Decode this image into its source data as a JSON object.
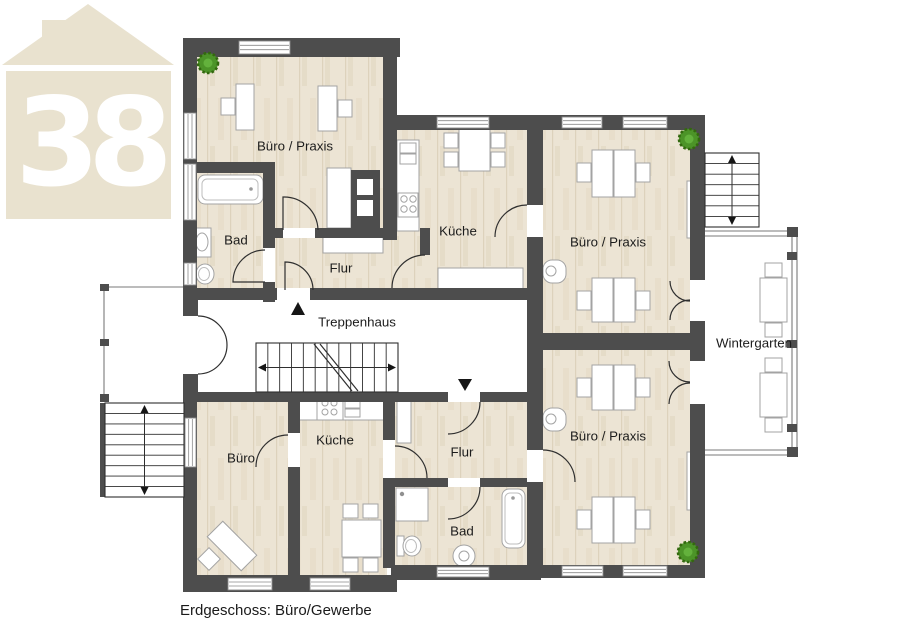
{
  "page": {
    "background": "#ffffff"
  },
  "caption": "Erdgeschoss: Büro/Gewerbe",
  "logo": {
    "number": "38",
    "color": "#e9e2cf"
  },
  "colors": {
    "wall": "#4d4d4d",
    "line": "#2f2f2f",
    "furniture_stroke": "#a3a3a3",
    "window_frame": "#8a8a8a",
    "frame": "#7a7a7a",
    "text": "#1c1c1c",
    "plant": "#4c9428",
    "plant_dark": "#33680f",
    "plant_light": "#63b13c",
    "wood_base": "#ece4d4",
    "wood_grain": "#ddd2bc"
  },
  "floorplan": {
    "wood_floors": [
      [
        197,
        52,
        190,
        184
      ],
      [
        197,
        170,
        70,
        126
      ],
      [
        268,
        230,
        162,
        62
      ],
      [
        395,
        128,
        135,
        165
      ],
      [
        540,
        128,
        152,
        205
      ],
      [
        540,
        350,
        152,
        218
      ],
      [
        197,
        398,
        95,
        180
      ],
      [
        296,
        398,
        91,
        180
      ],
      [
        391,
        398,
        138,
        84
      ],
      [
        391,
        484,
        138,
        84
      ]
    ],
    "white_floors": [
      [
        197,
        300,
        330,
        92
      ],
      [
        106,
        288,
        78,
        114
      ],
      [
        705,
        237,
        87,
        213
      ]
    ],
    "furniture": [
      {
        "n": "desk",
        "t": "r",
        "x": 236,
        "y": 84,
        "w": 18,
        "h": 46
      },
      {
        "n": "office-chair",
        "t": "r",
        "x": 221,
        "y": 98,
        "w": 14,
        "h": 17
      },
      {
        "n": "desk",
        "t": "r",
        "x": 318,
        "y": 86,
        "w": 19,
        "h": 45
      },
      {
        "n": "office-chair",
        "t": "r",
        "x": 338,
        "y": 100,
        "w": 14,
        "h": 17
      },
      {
        "n": "kitchenette-counter",
        "t": "r",
        "x": 327,
        "y": 168,
        "w": 24,
        "h": 60
      },
      {
        "n": "duct-block",
        "t": "r",
        "x": 351,
        "y": 170,
        "w": 29,
        "h": 58,
        "f": "#4d4d4d",
        "s": "none"
      },
      {
        "n": "duct-vent",
        "t": "r",
        "x": 357,
        "y": 179,
        "w": 16,
        "h": 16,
        "s": "none"
      },
      {
        "n": "duct-vent",
        "t": "r",
        "x": 357,
        "y": 200,
        "w": 16,
        "h": 16,
        "s": "none"
      },
      {
        "n": "bathtub",
        "t": "r",
        "x": 198,
        "y": 175,
        "w": 65,
        "h": 29,
        "rx": 7
      },
      {
        "n": "bathtub-inner",
        "t": "r",
        "x": 202,
        "y": 179,
        "w": 56,
        "h": 21,
        "rx": 5,
        "s": "#bdbdbd"
      },
      {
        "n": "drain",
        "t": "c",
        "x": 251,
        "y": 189,
        "r": 1.8,
        "f": "#9a9a9a",
        "s": "none"
      },
      {
        "n": "washbasin",
        "t": "r",
        "x": 194,
        "y": 228,
        "w": 17,
        "h": 29
      },
      {
        "n": "washbasin-bowl",
        "t": "e",
        "x": 202,
        "y": 242,
        "rx": 6,
        "ry": 9
      },
      {
        "n": "toilet-tank",
        "t": "r",
        "x": 189,
        "y": 264,
        "w": 7,
        "h": 21
      },
      {
        "n": "toilet-bowl",
        "t": "e",
        "x": 205,
        "y": 274,
        "rx": 9,
        "ry": 10
      },
      {
        "n": "toilet-seat",
        "t": "e",
        "x": 204,
        "y": 274,
        "rx": 5.5,
        "ry": 6.5,
        "s": "#bdbdbd"
      },
      {
        "n": "kitchen-counter",
        "t": "r",
        "x": 397,
        "y": 140,
        "w": 22,
        "h": 91
      },
      {
        "n": "sink-basin",
        "t": "r",
        "x": 400,
        "y": 143,
        "w": 16,
        "h": 10
      },
      {
        "n": "sink-basin",
        "t": "r",
        "x": 400,
        "y": 154,
        "w": 16,
        "h": 10
      },
      {
        "n": "stove",
        "t": "r",
        "x": 398,
        "y": 193,
        "w": 20,
        "h": 24
      },
      {
        "n": "burner",
        "t": "c",
        "x": 404,
        "y": 199,
        "r": 3.2
      },
      {
        "n": "burner",
        "t": "c",
        "x": 413,
        "y": 199,
        "r": 3.2
      },
      {
        "n": "burner",
        "t": "c",
        "x": 404,
        "y": 209,
        "r": 3.2
      },
      {
        "n": "burner",
        "t": "c",
        "x": 413,
        "y": 209,
        "r": 3.2
      },
      {
        "n": "dining-table",
        "t": "r",
        "x": 459,
        "y": 127,
        "w": 31,
        "h": 44
      },
      {
        "n": "chair",
        "t": "r",
        "x": 444,
        "y": 133,
        "w": 14,
        "h": 15
      },
      {
        "n": "chair",
        "t": "r",
        "x": 444,
        "y": 152,
        "w": 14,
        "h": 15
      },
      {
        "n": "chair",
        "t": "r",
        "x": 491,
        "y": 133,
        "w": 14,
        "h": 15
      },
      {
        "n": "chair",
        "t": "r",
        "x": 491,
        "y": 152,
        "w": 14,
        "h": 15
      },
      {
        "n": "sideboard",
        "t": "r",
        "x": 438,
        "y": 268,
        "w": 85,
        "h": 24
      },
      {
        "n": "sideboard",
        "t": "r",
        "x": 323,
        "y": 236,
        "w": 60,
        "h": 17
      },
      {
        "n": "desk",
        "t": "r",
        "x": 592,
        "y": 150,
        "w": 21,
        "h": 47
      },
      {
        "n": "desk",
        "t": "r",
        "x": 614,
        "y": 150,
        "w": 21,
        "h": 47
      },
      {
        "n": "office-chair",
        "t": "r",
        "x": 577,
        "y": 163,
        "w": 14,
        "h": 19
      },
      {
        "n": "office-chair",
        "t": "r",
        "x": 636,
        "y": 163,
        "w": 14,
        "h": 19
      },
      {
        "n": "desk",
        "t": "r",
        "x": 592,
        "y": 278,
        "w": 21,
        "h": 44
      },
      {
        "n": "desk",
        "t": "r",
        "x": 614,
        "y": 278,
        "w": 21,
        "h": 44
      },
      {
        "n": "office-chair",
        "t": "r",
        "x": 577,
        "y": 291,
        "w": 14,
        "h": 19
      },
      {
        "n": "office-chair",
        "t": "r",
        "x": 636,
        "y": 291,
        "w": 14,
        "h": 19
      },
      {
        "n": "shelf",
        "t": "r",
        "x": 687,
        "y": 181,
        "w": 16,
        "h": 57
      },
      {
        "n": "fountain",
        "t": "r",
        "x": 543,
        "y": 260,
        "w": 23,
        "h": 23,
        "rx": 9
      },
      {
        "n": "fountain-bowl",
        "t": "c",
        "x": 551,
        "y": 271,
        "r": 5
      },
      {
        "n": "desk",
        "t": "r",
        "x": 592,
        "y": 365,
        "w": 21,
        "h": 45
      },
      {
        "n": "desk",
        "t": "r",
        "x": 614,
        "y": 365,
        "w": 21,
        "h": 45
      },
      {
        "n": "office-chair",
        "t": "r",
        "x": 577,
        "y": 378,
        "w": 14,
        "h": 19
      },
      {
        "n": "office-chair",
        "t": "r",
        "x": 636,
        "y": 378,
        "w": 14,
        "h": 19
      },
      {
        "n": "desk",
        "t": "r",
        "x": 592,
        "y": 497,
        "w": 21,
        "h": 46
      },
      {
        "n": "desk",
        "t": "r",
        "x": 614,
        "y": 497,
        "w": 21,
        "h": 46
      },
      {
        "n": "office-chair",
        "t": "r",
        "x": 577,
        "y": 510,
        "w": 14,
        "h": 19
      },
      {
        "n": "office-chair",
        "t": "r",
        "x": 636,
        "y": 510,
        "w": 14,
        "h": 19
      },
      {
        "n": "shelf",
        "t": "r",
        "x": 687,
        "y": 452,
        "w": 16,
        "h": 58
      },
      {
        "n": "fountain",
        "t": "r",
        "x": 543,
        "y": 408,
        "w": 23,
        "h": 23,
        "rx": 9
      },
      {
        "n": "fountain-bowl",
        "t": "c",
        "x": 551,
        "y": 419,
        "r": 5
      },
      {
        "n": "bistro-table",
        "t": "r",
        "x": 760,
        "y": 278,
        "w": 27,
        "h": 44
      },
      {
        "n": "chair",
        "t": "r",
        "x": 765,
        "y": 263,
        "w": 17,
        "h": 14
      },
      {
        "n": "chair",
        "t": "r",
        "x": 765,
        "y": 323,
        "w": 17,
        "h": 14
      },
      {
        "n": "bistro-table",
        "t": "r",
        "x": 760,
        "y": 373,
        "w": 27,
        "h": 44
      },
      {
        "n": "chair",
        "t": "r",
        "x": 765,
        "y": 358,
        "w": 17,
        "h": 14
      },
      {
        "n": "chair",
        "t": "r",
        "x": 765,
        "y": 418,
        "w": 17,
        "h": 14
      },
      {
        "n": "corner-desk",
        "t": "rot",
        "x": 232,
        "y": 546,
        "w": 48,
        "h": 22,
        "a": 45
      },
      {
        "n": "office-chair",
        "t": "rot",
        "x": 209,
        "y": 559,
        "w": 16,
        "h": 16,
        "a": 45
      },
      {
        "n": "kitchen-counter",
        "t": "r",
        "x": 297,
        "y": 397,
        "w": 87,
        "h": 23
      },
      {
        "n": "stove",
        "t": "r",
        "x": 317,
        "y": 397,
        "w": 26,
        "h": 23
      },
      {
        "n": "burner",
        "t": "c",
        "x": 325,
        "y": 403,
        "r": 3
      },
      {
        "n": "burner",
        "t": "c",
        "x": 334,
        "y": 403,
        "r": 3
      },
      {
        "n": "burner",
        "t": "c",
        "x": 325,
        "y": 412,
        "r": 3
      },
      {
        "n": "burner",
        "t": "c",
        "x": 334,
        "y": 412,
        "r": 3
      },
      {
        "n": "sink-basin",
        "t": "r",
        "x": 345,
        "y": 400,
        "w": 15,
        "h": 8
      },
      {
        "n": "sink-basin",
        "t": "r",
        "x": 345,
        "y": 409,
        "w": 15,
        "h": 8
      },
      {
        "n": "dining-table",
        "t": "r",
        "x": 342,
        "y": 520,
        "w": 39,
        "h": 37
      },
      {
        "n": "chair",
        "t": "r",
        "x": 343,
        "y": 504,
        "w": 15,
        "h": 14
      },
      {
        "n": "chair",
        "t": "r",
        "x": 363,
        "y": 504,
        "w": 15,
        "h": 14
      },
      {
        "n": "chair",
        "t": "r",
        "x": 343,
        "y": 558,
        "w": 15,
        "h": 14
      },
      {
        "n": "chair",
        "t": "r",
        "x": 363,
        "y": 558,
        "w": 15,
        "h": 14
      },
      {
        "n": "shelf",
        "t": "r",
        "x": 397,
        "y": 401,
        "w": 14,
        "h": 42
      },
      {
        "n": "shower",
        "t": "r",
        "x": 396,
        "y": 488,
        "w": 32,
        "h": 33
      },
      {
        "n": "shower-drain",
        "t": "c",
        "x": 402,
        "y": 494,
        "r": 2.2,
        "f": "#909090",
        "s": "none"
      },
      {
        "n": "toilet-tank",
        "t": "r",
        "x": 397,
        "y": 536,
        "w": 7,
        "h": 20
      },
      {
        "n": "toilet-bowl",
        "t": "e",
        "x": 412,
        "y": 546,
        "rx": 9,
        "ry": 10
      },
      {
        "n": "toilet-seat",
        "t": "e",
        "x": 411,
        "y": 546,
        "rx": 5.5,
        "ry": 6.5,
        "s": "#bdbdbd"
      },
      {
        "n": "pedestal-sink",
        "t": "c",
        "x": 464,
        "y": 556,
        "r": 11
      },
      {
        "n": "pedestal-sink-bowl",
        "t": "c",
        "x": 464,
        "y": 556,
        "r": 5
      },
      {
        "n": "bathtub",
        "t": "r",
        "x": 502,
        "y": 489,
        "w": 23,
        "h": 59,
        "rx": 7
      },
      {
        "n": "bathtub-inner",
        "t": "r",
        "x": 505,
        "y": 493,
        "w": 17,
        "h": 51,
        "rx": 5,
        "s": "#bdbdbd"
      },
      {
        "n": "drain",
        "t": "c",
        "x": 513,
        "y": 498,
        "r": 1.8,
        "f": "#9a9a9a",
        "s": "none"
      }
    ],
    "walls": [
      [
        183,
        38,
        217,
        19
      ],
      [
        183,
        38,
        14,
        260
      ],
      [
        183,
        298,
        15,
        18
      ],
      [
        183,
        374,
        15,
        20
      ],
      [
        183,
        392,
        14,
        200
      ],
      [
        183,
        575,
        214,
        17
      ],
      [
        391,
        565,
        150,
        15
      ],
      [
        535,
        565,
        170,
        13
      ],
      [
        383,
        115,
        322,
        15
      ],
      [
        690,
        130,
        15,
        448
      ],
      [
        383,
        57,
        14,
        183
      ],
      [
        183,
        162,
        92,
        11
      ],
      [
        263,
        162,
        12,
        140
      ],
      [
        263,
        228,
        120,
        10
      ],
      [
        420,
        228,
        10,
        27
      ],
      [
        183,
        288,
        247,
        12
      ],
      [
        420,
        288,
        123,
        12
      ],
      [
        527,
        130,
        16,
        273
      ],
      [
        527,
        333,
        178,
        17
      ],
      [
        527,
        350,
        16,
        215
      ],
      [
        183,
        392,
        357,
        10
      ],
      [
        288,
        400,
        12,
        178
      ],
      [
        383,
        400,
        12,
        168
      ],
      [
        391,
        478,
        138,
        9
      ],
      [
        100,
        403,
        9,
        94
      ]
    ],
    "door_cuts": [
      [
        283,
        228,
        32,
        10
      ],
      [
        263,
        248,
        12,
        34
      ],
      [
        277,
        288,
        33,
        12
      ],
      [
        185,
        316,
        13,
        58
      ],
      [
        527,
        205,
        16,
        32
      ],
      [
        690,
        280,
        15,
        41
      ],
      [
        690,
        361,
        15,
        43
      ],
      [
        448,
        392,
        32,
        10
      ],
      [
        288,
        433,
        12,
        34
      ],
      [
        383,
        440,
        12,
        38
      ],
      [
        448,
        478,
        32,
        9
      ],
      [
        527,
        450,
        16,
        32
      ]
    ],
    "windows": [
      [
        239,
        41,
        51,
        13,
        "h"
      ],
      [
        184,
        113,
        12,
        46,
        "v"
      ],
      [
        184,
        164,
        12,
        56,
        "v"
      ],
      [
        184,
        263,
        12,
        22,
        "v"
      ],
      [
        437,
        117,
        52,
        11,
        "h"
      ],
      [
        562,
        117,
        40,
        11,
        "h"
      ],
      [
        623,
        117,
        44,
        11,
        "h"
      ],
      [
        185,
        418,
        11,
        49,
        "v"
      ],
      [
        228,
        578,
        44,
        12,
        "h"
      ],
      [
        310,
        578,
        40,
        12,
        "h"
      ],
      [
        437,
        567,
        52,
        10,
        "h"
      ],
      [
        562,
        566,
        41,
        10,
        "h"
      ],
      [
        623,
        566,
        44,
        10,
        "h"
      ]
    ],
    "doors": [
      "M 283 230 L 283 197 A 34 34 0 0 1 318 230",
      "M 265 282 L 233 282 A 32 32 0 0 1 265 250",
      "M 285 290 L 285 262 A 28 28 0 0 1 313 290",
      "M 425 255 A 33 33 0 0 0 392 288",
      "M 527 205 A 32 32 0 0 0 495 237",
      "M 543 450 A 32 32 0 0 1 575 482",
      "M 198 316 A 29 29 0 0 1 227 345",
      "M 198 374 A 29 29 0 0 0 227 345",
      "M 670 281 A 20 20 0 0 0 690 301",
      "M 670 320 A 20 20 0 0 1 690 300",
      "M 669 361 A 21 21 0 0 0 690 382",
      "M 669 404 A 21 21 0 0 1 690 383",
      "M 288 435 A 32 32 0 0 0 256 467",
      "M 480 402 A 32 32 0 0 1 448 434",
      "M 395 446 A 32 32 0 0 1 427 478",
      "M 480 487 A 32 32 0 0 1 448 519"
    ],
    "frame_lines": [
      [
        705,
        231,
        797,
        231
      ],
      [
        705,
        236,
        797,
        236
      ],
      [
        792,
        231,
        792,
        455
      ],
      [
        797,
        231,
        797,
        455
      ],
      [
        705,
        450,
        797,
        450
      ],
      [
        705,
        455,
        797,
        455
      ],
      [
        104,
        287,
        183,
        287
      ],
      [
        104,
        287,
        104,
        402
      ]
    ],
    "posts": [
      [
        787,
        227,
        11,
        10
      ],
      [
        787,
        252,
        10,
        8
      ],
      [
        787,
        340,
        10,
        8
      ],
      [
        787,
        424,
        10,
        8
      ],
      [
        787,
        447,
        11,
        10
      ],
      [
        100,
        284,
        9,
        7
      ],
      [
        100,
        339,
        9,
        7
      ],
      [
        100,
        394,
        9,
        8
      ]
    ],
    "stairs": [
      {
        "x": 256,
        "y": 343,
        "w": 142,
        "h": 49,
        "dir": "h",
        "steps": 12,
        "diag": [
          [
            314,
            344,
            352,
            391
          ],
          [
            320,
            344,
            358,
            391
          ]
        ]
      },
      {
        "x": 105,
        "y": 403,
        "w": 79,
        "h": 94,
        "dir": "v",
        "steps": 9
      },
      {
        "x": 705,
        "y": 153,
        "w": 54,
        "h": 74,
        "dir": "v",
        "steps": 7
      }
    ],
    "plants": [
      [
        208,
        63
      ],
      [
        689,
        139
      ],
      [
        688,
        552
      ]
    ],
    "direction_arrows": [
      "298,302 291,315 305,315",
      "465,391 472,379 458,379"
    ],
    "room_labels": [
      {
        "text": "Büro / Praxis",
        "x": 295,
        "y": 146
      },
      {
        "text": "Bad",
        "x": 236,
        "y": 240
      },
      {
        "text": "Flur",
        "x": 341,
        "y": 268
      },
      {
        "text": "Küche",
        "x": 458,
        "y": 231
      },
      {
        "text": "Büro / Praxis",
        "x": 608,
        "y": 242
      },
      {
        "text": "Treppenhaus",
        "x": 357,
        "y": 322
      },
      {
        "text": "Wintergarten",
        "x": 754,
        "y": 343
      },
      {
        "text": "Büro",
        "x": 241,
        "y": 458
      },
      {
        "text": "Küche",
        "x": 335,
        "y": 440
      },
      {
        "text": "Flur",
        "x": 462,
        "y": 452
      },
      {
        "text": "Bad",
        "x": 462,
        "y": 531
      },
      {
        "text": "Büro / Praxis",
        "x": 608,
        "y": 436
      }
    ]
  }
}
